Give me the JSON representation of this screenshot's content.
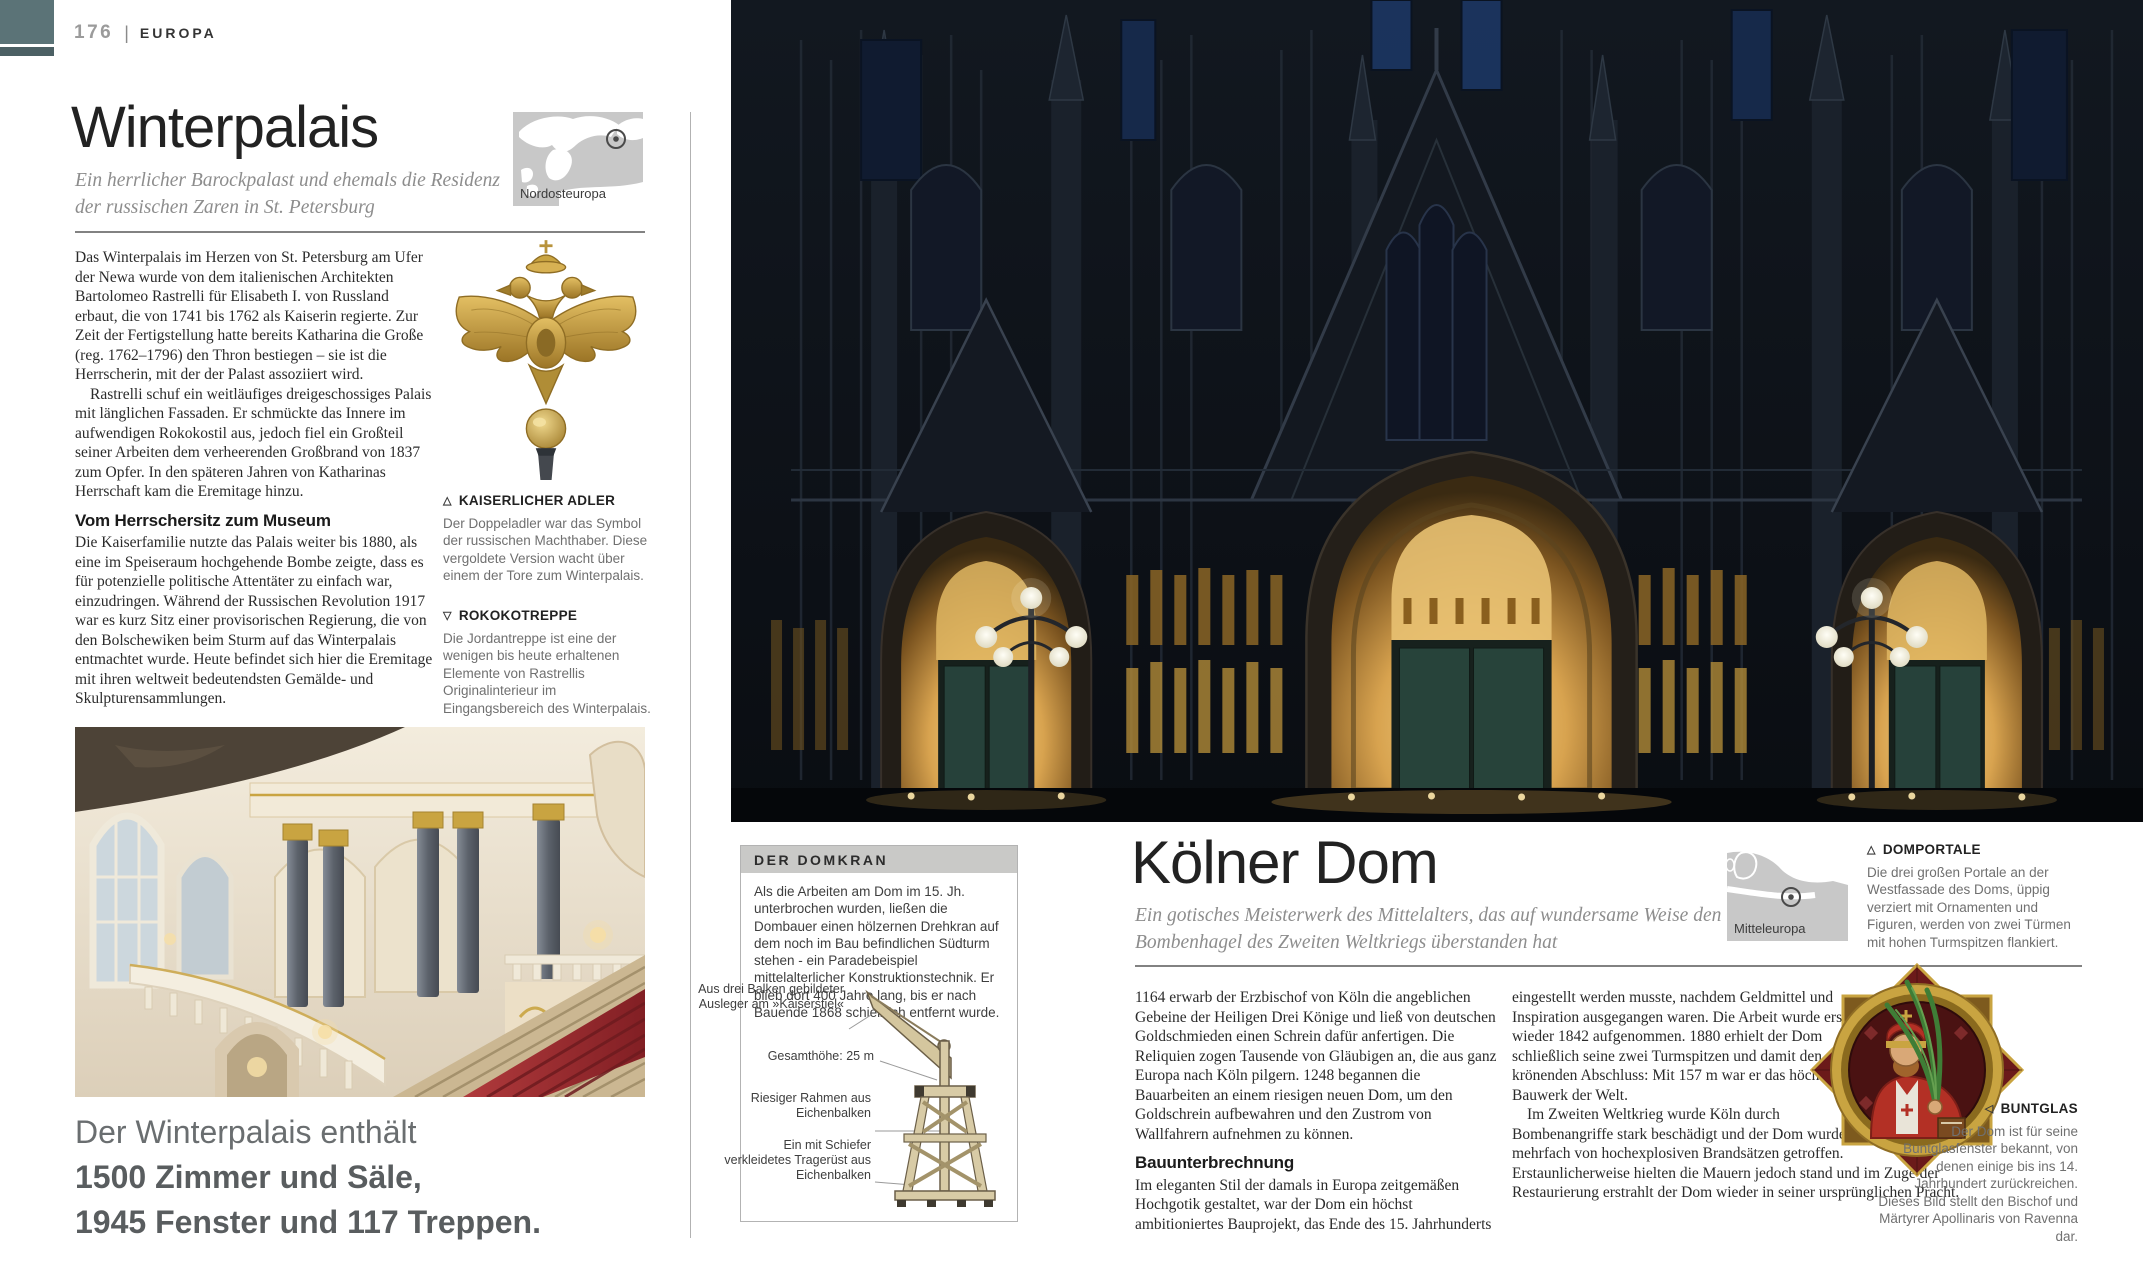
{
  "header": {
    "page_number": "176",
    "separator": "|",
    "section": "EUROPA"
  },
  "colors": {
    "tab_teal": "#5b7377",
    "tab_teal_dark": "#4c6064",
    "gold": "#c9a441",
    "carpet_red": "#a5343a",
    "caption_gray": "#707070",
    "box_header_gray": "#c9c9c7"
  },
  "winterpalais": {
    "title": "Winterpalais",
    "subtitle": "Ein herrlicher Barockpalast und ehemals die Residenz der russischen Zaren in St. Petersburg",
    "map_label": "Nordosteuropa",
    "para1": "Das Winterpalais im Herzen von St. Petersburg am Ufer der Newa wurde von dem italienischen Architekten Bartolomeo Rastrelli für Elisabeth I. von Russland erbaut, die von 1741 bis 1762 als Kaiserin regierte. Zur Zeit der Fertigstellung hatte bereits Katharina die Große (reg. 1762–1796) den Thron bestiegen – sie ist die Herrscherin, mit der der Palast assoziiert wird.",
    "para2": "Rastrelli schuf ein weitläufiges dreigeschossiges Palais mit länglichen Fassaden. Er schmückte das Innere im aufwendigen Rokokostil aus, jedoch fiel ein Großteil seiner Arbeiten dem verheerenden Großbrand von 1837 zum Opfer. In den späteren Jahren von Katharinas Herrschaft kam die Eremitage hinzu.",
    "heading2": "Vom Herrschersitz zum Museum",
    "para3": "Die Kaiserfamilie nutzte das Palais weiter bis 1880, als eine im Speiseraum hochgehende Bombe zeigte, dass es für potenzielle politische Attentäter zu einfach war, einzudringen. Während der Russischen Revolution 1917 war es kurz Sitz einer provisorischen Regierung, die von den Bolschewiken beim Sturm auf das Winterpalais entmachtet wurde. Heute befindet sich hier die Eremitage mit ihren weltweit bedeutendsten Gemälde- und Skulpturensammlungen.",
    "adler": {
      "marker": "△",
      "title": "KAISERLICHER ADLER",
      "text": "Der Doppeladler war das Symbol der russischen Machthaber. Diese vergoldete Version wacht über einem der Tore zum Winterpalais."
    },
    "treppe": {
      "marker": "▽",
      "title": "ROKOKOTREPPE",
      "text": "Die Jordantreppe ist eine der wenigen bis heute erhaltenen Elemente von Rastrellis Originalinterieur im Eingangsbereich des Winterpalais."
    },
    "statement_line1": "Der Winterpalais enthält",
    "statement_line2": "1500 Zimmer und Säle,",
    "statement_line3": "1945 Fenster und 117 Treppen."
  },
  "domkran": {
    "title": "DER DOMKRAN",
    "text": "Als die Arbeiten am Dom im 15. Jh. unterbrochen wurden, ließen die Dombauer einen hölzernen Drehkran auf dem noch im Bau befindlichen Südturm stehen - ein Paradebeispiel mittelalterlicher Konstruktionstechnik. Er blieb dort 400 Jahre lang, bis er nach Bauende 1868 schießlich entfernt wurde.",
    "labels": [
      "Aus drei Balken gebildeter Ausleger am »Kaiserstiel«",
      "Gesamthöhe: 25 m",
      "Riesiger Rahmen aus Eichenbalken",
      "Ein mit Schiefer verkleidetes Tragerüst aus Eichenbalken"
    ]
  },
  "koelnerdom": {
    "title": "Kölner Dom",
    "subtitle": "Ein gotisches Meisterwerk des Mittelalters, das auf wundersame Weise den Bombenhagel des Zweiten Weltkriegs überstanden hat",
    "map_label": "Mitteleuropa",
    "portale": {
      "marker": "△",
      "title": "DOMPORTALE",
      "text": "Die drei großen Portale an der Westfassade des Doms, üppig verziert mit Ornamenten und Figuren, werden von zwei Türmen mit hohen Turmspitzen flankiert."
    },
    "para1": "1164 erwarb der Erzbischof von Köln die angeblichen Gebeine der Heiligen Drei Könige und ließ von deutschen Goldschmieden einen Schrein dafür anfertigen. Die Reliquien zogen Tausende von Gläubigen an, die aus ganz Europa nach Köln pilgern. 1248 begannen die Bauarbeiten an einem riesigen neuen Dom, um den Goldschrein aufbewahren und den Zustrom von Wallfahrern aufnehmen zu können.",
    "heading2": "Bauunterbrechnung",
    "para2": "Im eleganten Stil der damals in Europa zeitgemäßen Hochgotik gestaltet, war der Dom ein höchst ambitioniertes Bauprojekt, das Ende des 15. Jahrhunderts",
    "para3": "eingestellt werden musste, nachdem Geldmittel und Inspiration ausgegangen waren. Die Arbeit wurde erst wieder 1842 aufgenommen. 1880 erhielt der Dom schließlich seine zwei Turmspitzen und damit den krönenden Abschluss: Mit 157 m war er das höchste Bauwerk der Welt.",
    "para4": "Im Zweiten Weltkrieg wurde Köln durch Bombenangriffe stark beschädigt und der Dom wurde mehrfach von hochexplosiven Brandsätzen getroffen. Erstaunlicherweise hielten die Mauern jedoch stand und im Zuge der Restaurierung erstrahlt der Dom wieder in seiner ursprünglichen Pracht.",
    "buntglas": {
      "marker": "◁",
      "title": "BUNTGLAS",
      "text": "Der Dom ist für seine Buntglasfenster bekannt, von denen einige bis ins 14. Jahrhundert zurückreichen. Dieses Bild stellt den Bischof und Märtyrer Apollinaris von Ravenna dar."
    }
  }
}
